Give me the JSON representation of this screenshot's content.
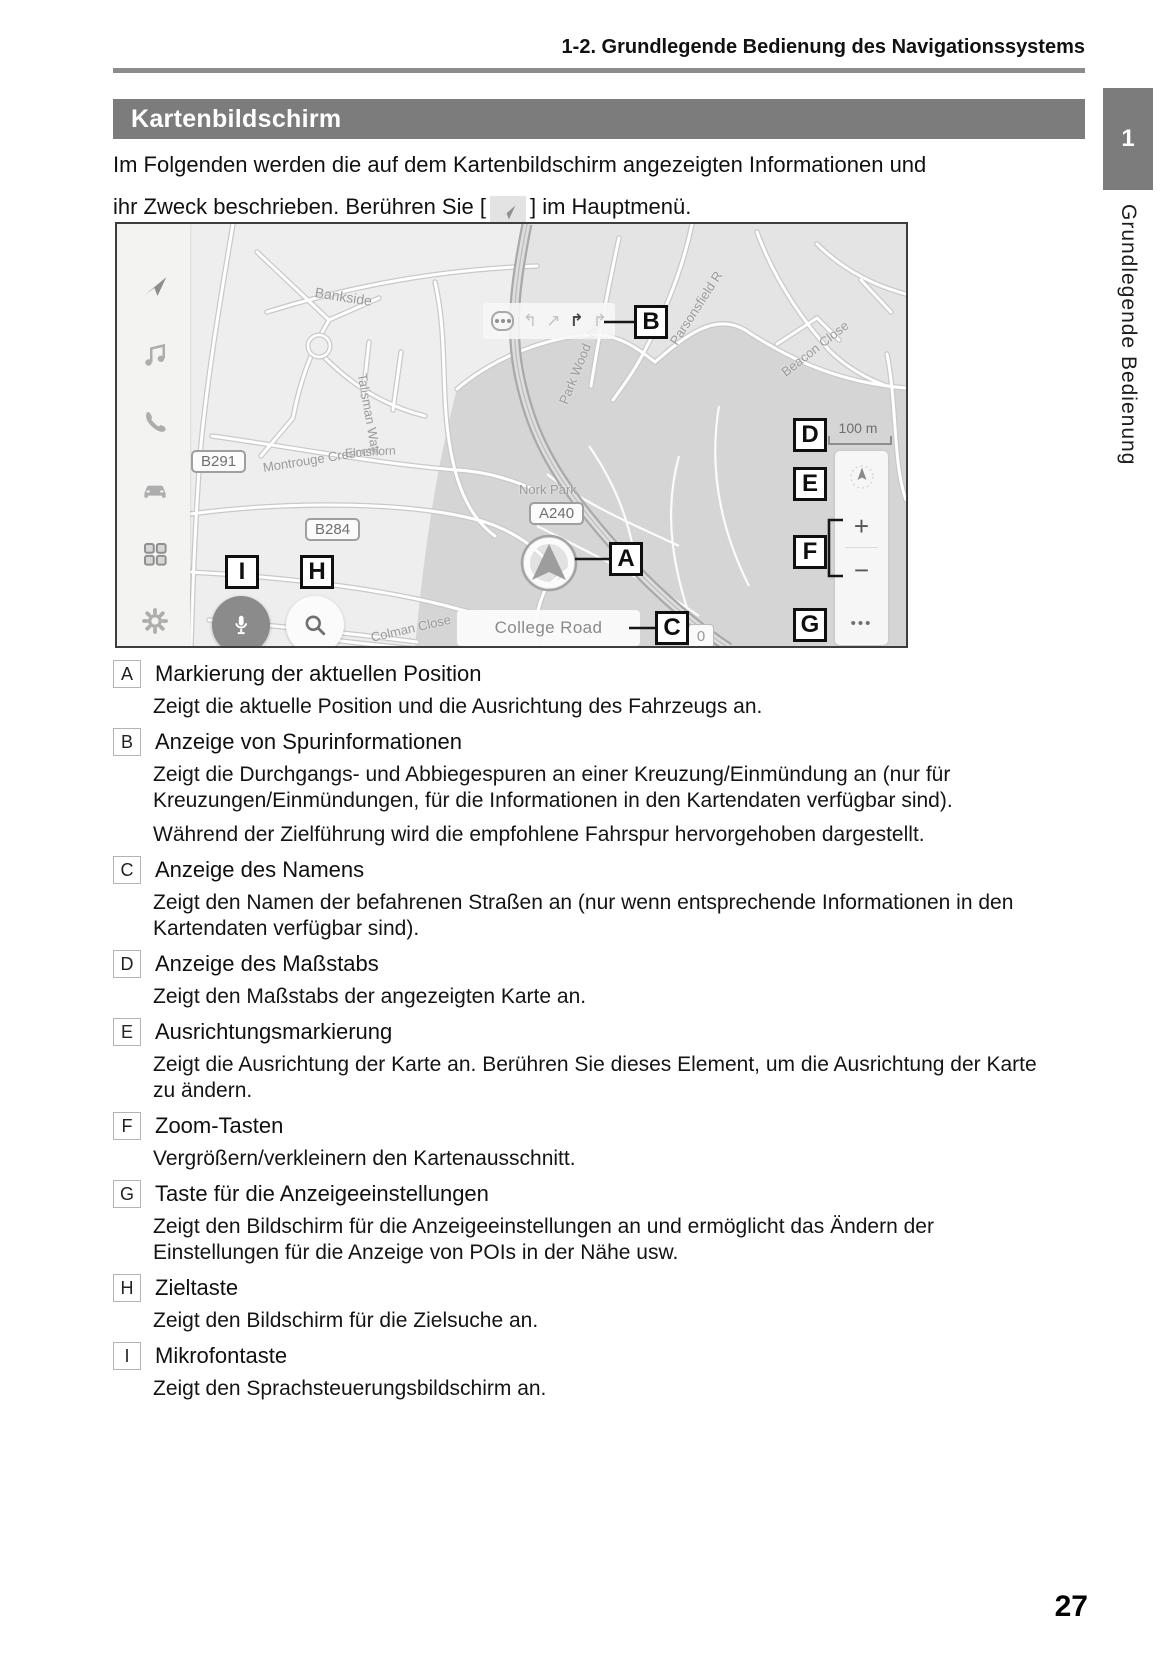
{
  "header": {
    "running_head": "1-2. Grundlegende Bedienung des Navigationssystems",
    "chapter_number": "1",
    "chapter_title": "Grundlegende Bedienung"
  },
  "section": {
    "title": "Kartenbildschirm"
  },
  "intro": {
    "line1": "Im Folgenden werden die auf dem Kartenbildschirm angezeigten Informationen und",
    "line2_before": "ihr Zweck beschrieben. Berühren Sie [",
    "line2_icon": "navigation-arrow-icon",
    "line2_after": "] im Hauptmenü."
  },
  "map": {
    "sidebar_icons": [
      "navigation-icon",
      "music-icon",
      "phone-icon",
      "car-icon",
      "apps-grid-icon",
      "settings-gear-icon"
    ],
    "scale_label": "100 m",
    "road_name_bar": "College Road",
    "counter_badge": "0",
    "zoom_in_label": "+",
    "zoom_out_label": "−",
    "more_options_label": "•••",
    "park_name": "Nork Park",
    "road_badges": [
      {
        "text": "B291",
        "x": 74,
        "y": 226
      },
      {
        "text": "B284",
        "x": 188,
        "y": 294
      },
      {
        "text": "A240",
        "x": 412,
        "y": 278
      }
    ],
    "street_labels": [
      {
        "text": "Bankside",
        "x": 198,
        "y": 60,
        "rot": 9,
        "size": 14
      },
      {
        "text": "Talisman Way",
        "x": 245,
        "y": 142,
        "rot": 80,
        "size": 13
      },
      {
        "text": "Montrouge Crescent",
        "x": 146,
        "y": 236,
        "rot": -9,
        "size": 13
      },
      {
        "text": "Elmshorn",
        "x": 228,
        "y": 222,
        "rot": -3,
        "size": 12
      },
      {
        "text": "Nork Park",
        "x": 402,
        "y": 258,
        "rot": 0,
        "size": 13
      },
      {
        "text": "Beacon Close",
        "x": 666,
        "y": 142,
        "rot": -38,
        "size": 13
      },
      {
        "text": "Parsonsfield R",
        "x": 556,
        "y": 112,
        "rot": -57,
        "size": 13
      },
      {
        "text": "Park Wood View",
        "x": 446,
        "y": 172,
        "rot": -68,
        "size": 13
      },
      {
        "text": "Colman Close",
        "x": 254,
        "y": 406,
        "rot": -13,
        "size": 13
      }
    ],
    "callouts": [
      {
        "letter": "A",
        "x": 492,
        "y": 318
      },
      {
        "letter": "B",
        "x": 517,
        "y": 81
      },
      {
        "letter": "C",
        "x": 538,
        "y": 387
      },
      {
        "letter": "D",
        "x": 676,
        "y": 194
      },
      {
        "letter": "E",
        "x": 676,
        "y": 243
      },
      {
        "letter": "F",
        "x": 676,
        "y": 311
      },
      {
        "letter": "G",
        "x": 676,
        "y": 384
      },
      {
        "letter": "H",
        "x": 183,
        "y": 331
      },
      {
        "letter": "I",
        "x": 108,
        "y": 331
      }
    ]
  },
  "legend": {
    "items": [
      {
        "letter": "A",
        "term": "Markierung der aktuellen Position",
        "descs": [
          "Zeigt die aktuelle Position und die Ausrichtung des Fahrzeugs an."
        ]
      },
      {
        "letter": "B",
        "term": "Anzeige von Spurinformationen",
        "descs": [
          "Zeigt die Durchgangs- und Abbiegespuren an einer Kreuzung/Einmündung an (nur für Kreuzungen/Einmündungen, für die Informationen in den Kartendaten verfügbar sind).",
          "Während der Zielführung wird die empfohlene Fahrspur hervorgehoben dargestellt."
        ]
      },
      {
        "letter": "C",
        "term": "Anzeige des Namens",
        "descs": [
          "Zeigt den Namen der befahrenen Straßen an (nur wenn entsprechende Informationen in den Kartendaten verfügbar sind)."
        ]
      },
      {
        "letter": "D",
        "term": "Anzeige des Maßstabs",
        "descs": [
          "Zeigt den Maßstabs der angezeigten Karte an."
        ]
      },
      {
        "letter": "E",
        "term": "Ausrichtungsmarkierung",
        "descs": [
          "Zeigt die Ausrichtung der Karte an. Berühren Sie dieses Element, um die Ausrichtung der Karte zu ändern."
        ]
      },
      {
        "letter": "F",
        "term": "Zoom-Tasten",
        "descs": [
          "Vergrößern/verkleinern den Kartenausschnitt."
        ]
      },
      {
        "letter": "G",
        "term": "Taste für die Anzeigeeinstellungen",
        "descs": [
          "Zeigt den Bildschirm für die Anzeigeeinstellungen an und ermöglicht das Ändern der Einstellungen für die Anzeige von POIs in der Nähe usw."
        ]
      },
      {
        "letter": "H",
        "term": "Zieltaste",
        "descs": [
          "Zeigt den Bildschirm für die Zielsuche an."
        ]
      },
      {
        "letter": "I",
        "term": "Mikrofontaste",
        "descs": [
          "Zeigt den Sprachsteuerungsbildschirm an."
        ]
      }
    ]
  },
  "footer": {
    "page_number": "27"
  },
  "colors": {
    "accent_gray": "#7c7c7c",
    "map_park": "#d5d5d5",
    "callout_border": "#0f0f0f"
  }
}
